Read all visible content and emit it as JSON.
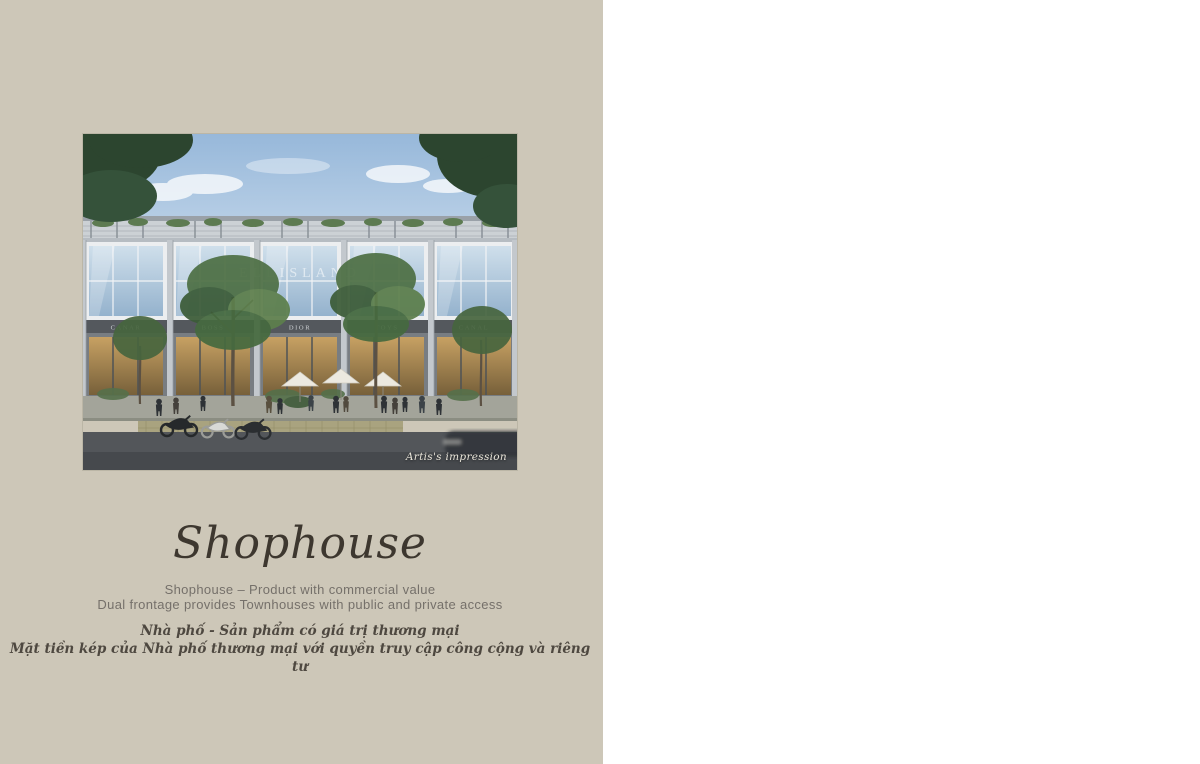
{
  "page": {
    "left_bg": "#cdc7b8",
    "right_bg": "#ffffff"
  },
  "left_panel": {
    "photo": {
      "caption": "Artis's impression",
      "glass_sign": "ELLISLAND",
      "band_signs": [
        "CANAR",
        "BOSS",
        "DIOR",
        "TOYS",
        "CANAL"
      ]
    },
    "title": "Shophouse",
    "description_en": {
      "line1": "Shophouse – Product with commercial value",
      "line2": "Dual frontage provides Townhouses with public and private access"
    },
    "description_vi": {
      "line1": "Nhà phố - Sản phẩm có giá trị thương mại",
      "line2": "Mặt tiền kép của Nhà phố thương mại với quyền truy cập công cộng và riêng tư"
    }
  },
  "right_panel": {
    "roof_plan_label": "TK06",
    "gfa": {
      "label": "GFA:",
      "value": ": 325m²",
      "col1": {
        "line1": "1ST FLOOR: 88m²",
        "line2": "2ND FLOOR: 87m²"
      },
      "col2": {
        "line1": "3RD FLOOR: 87m²",
        "line2": "4TH FLOOR: 63m²"
      }
    }
  }
}
